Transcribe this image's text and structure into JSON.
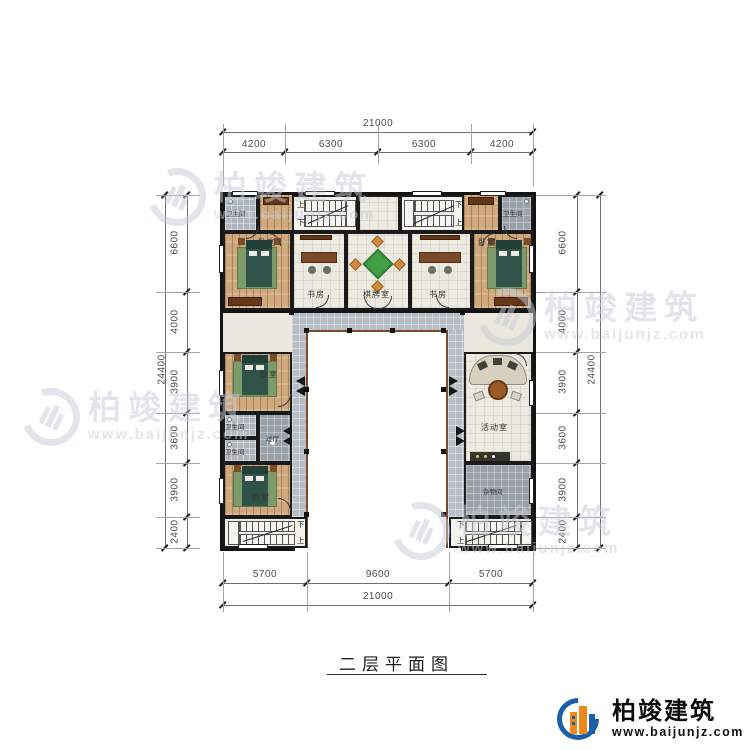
{
  "title": {
    "text": "二层平面图"
  },
  "logo": {
    "brand": "柏竣建筑",
    "url": "www.baijunjz.com"
  },
  "watermark": {
    "brand": "柏竣建筑",
    "url": "www.baijunjz.com"
  },
  "dims": {
    "top_total": "21000",
    "top_segs": [
      "4200",
      "6300",
      "6300",
      "4200"
    ],
    "bottom_segs": [
      "5700",
      "9600",
      "5700"
    ],
    "bottom_total": "21000",
    "left_total": "24400",
    "left_segs": [
      "6600",
      "4000",
      "3900",
      "3600",
      "3900",
      "2400"
    ],
    "right_total": "24400",
    "right_segs": [
      "6600",
      "4000",
      "3900",
      "3600",
      "3900",
      "2400"
    ]
  },
  "rooms": {
    "bath_top_left": "卫生间",
    "bed_top_left": "卧室",
    "study_left": "书房",
    "mahjong": "棋牌室",
    "study_right": "书房",
    "bed_top_right": "卧室",
    "bath_top_right": "卫生间",
    "bed_west_upper": "卧室",
    "bath_west_1": "卫生间",
    "bath_west_2": "卫生间",
    "hall": "过厅",
    "bed_west_lower": "卧室",
    "activity": "活动室",
    "storage": "杂物间"
  },
  "stairs": {
    "up": "上",
    "down": "下"
  },
  "colors": {
    "logo_blue": "#1a5fa8",
    "logo_orange": "#f0881c",
    "walkway_gray": "#b7bec6",
    "wood_floor": "#cfa87d",
    "bed_green": "#2f5349",
    "mahjong_green": "#43a047",
    "railing_brown": "#7a4a2c"
  }
}
